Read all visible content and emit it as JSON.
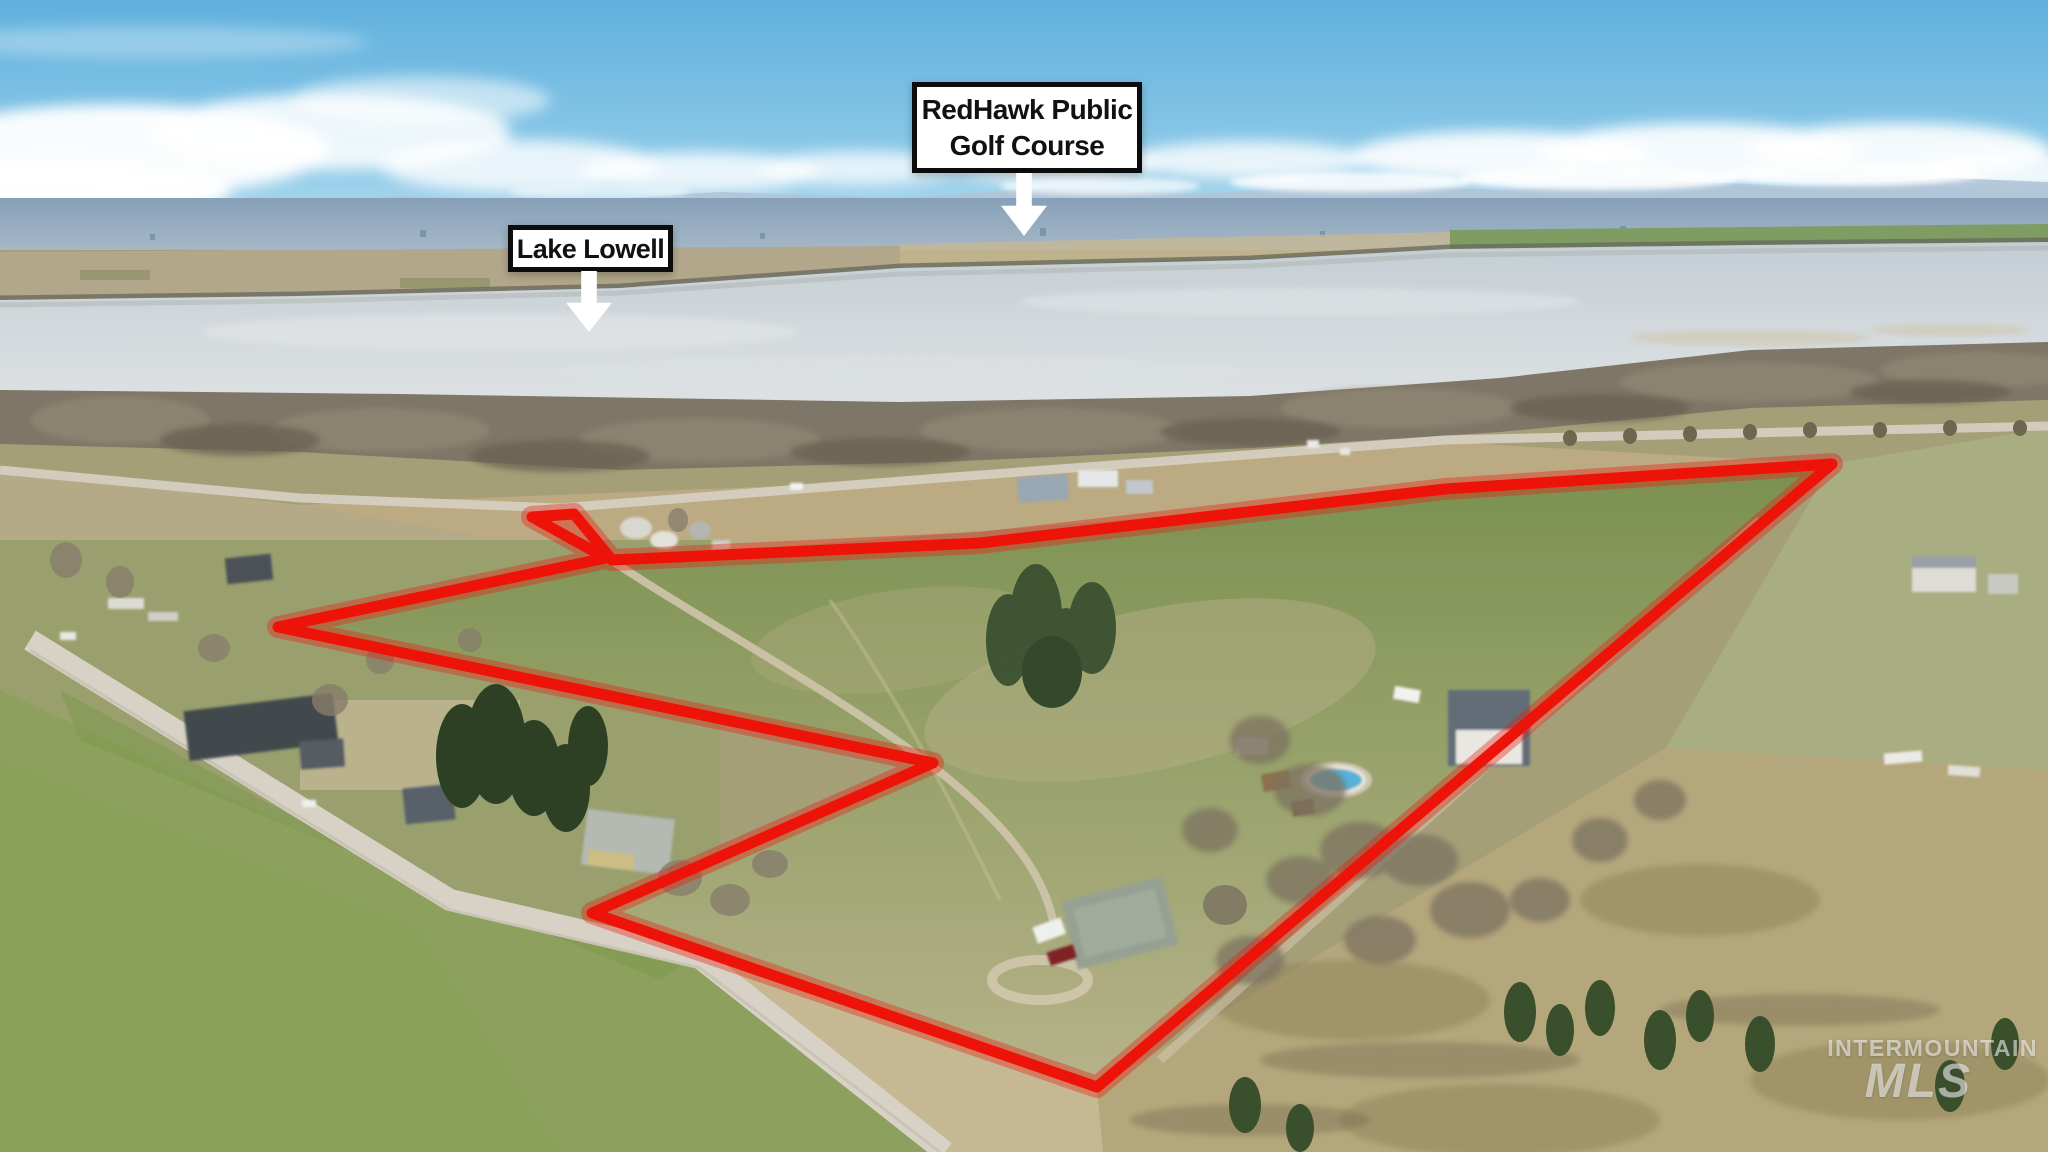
{
  "scene": {
    "description": "Aerial drone photograph of rural acreage outlined in red beside Lake Lowell, with distant city, snowy mountains and sky",
    "boundary_color": "#ee1309",
    "label_bg": "#ffffff",
    "label_border": "#0c0c0c",
    "sky_color": "#5fb0dd",
    "lake_color": "#ccd3d9"
  },
  "annotations": {
    "golf_label": {
      "line1": "RedHawk Public",
      "line2": "Golf Course"
    },
    "lake_label": {
      "text": "Lake Lowell"
    }
  },
  "watermark": {
    "line1": "INTERMOUNTAIN",
    "line2": "MLS"
  }
}
